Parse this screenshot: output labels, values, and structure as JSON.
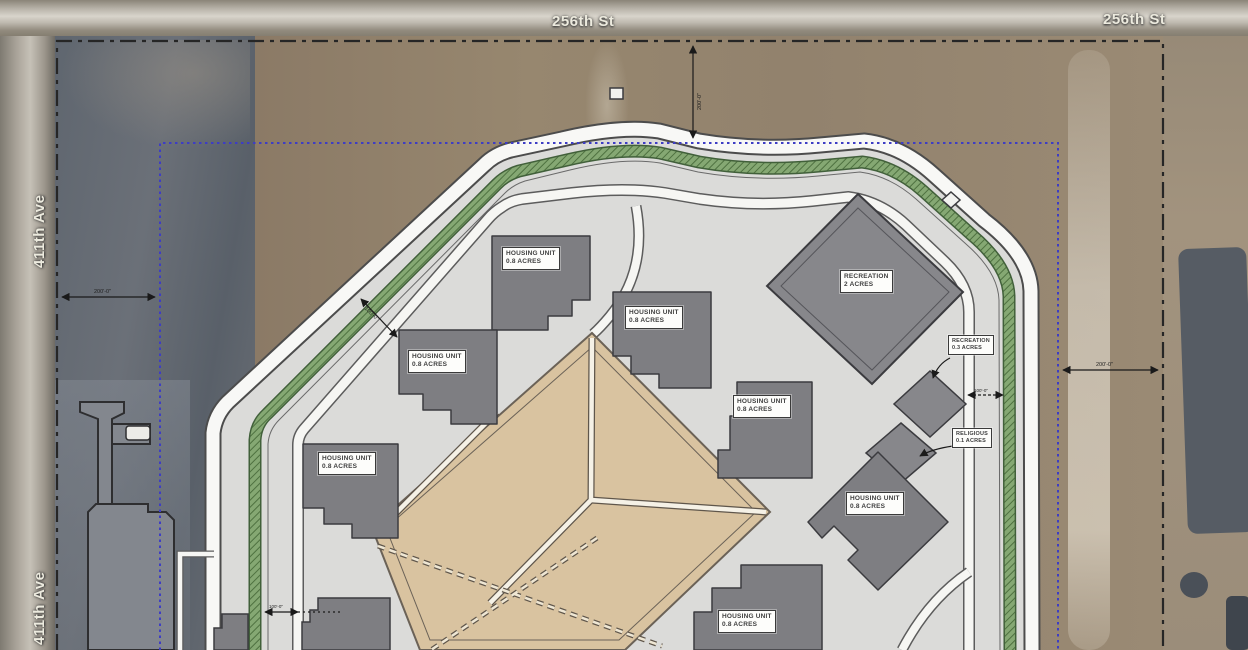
{
  "map": {
    "streets": {
      "top_center": "256th St",
      "top_right": "256th St",
      "left_upper": "411th Ave",
      "left_lower": "411th Ave"
    },
    "labels": {
      "housing": {
        "title": "HOUSING UNIT",
        "area": "0.8 ACRES"
      },
      "recreation_large": {
        "title": "RECREATION",
        "area": "2 ACRES"
      },
      "recreation_small": {
        "title": "RECREATION",
        "area": "0.3 ACRES"
      },
      "religious": {
        "title": "RELIGIOUS",
        "area": "0.1 ACRES"
      }
    },
    "dimensions": {
      "west_setback": "200'-0\"",
      "north_setback": "200'-0\"",
      "east_setback": "200'-0\"",
      "buffer_width": "100'-0\"",
      "recreation_gap": "100'-0\"",
      "south_gap": "100'-0\""
    },
    "legend_colors": {
      "parcel_boundary": "#262626",
      "security_boundary": "#3d3dc4",
      "landscape_buffer": "#6f9a5e",
      "building_fill": "#7e7e82",
      "yard_fill": "#d9c3a0"
    }
  }
}
